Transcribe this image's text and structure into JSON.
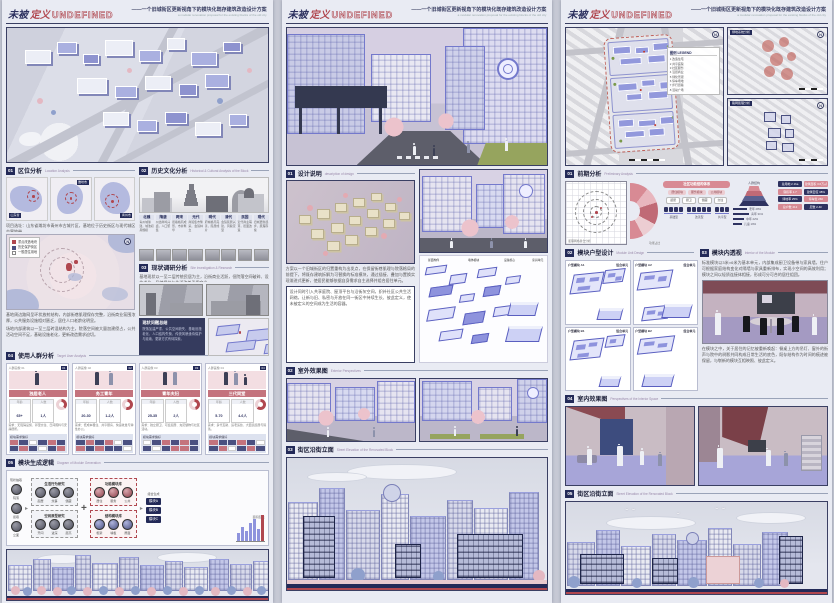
{
  "header": {
    "title_dark": "未被",
    "title_red": "定义",
    "title_en": "UNDEFINED",
    "subtitle": "——一个旧城街区更新视角下的模块化既存建筑改造设计方案",
    "subtitle_en": "a modular renovation proposal for the existing blocks of the old city"
  },
  "panel1": {
    "s1": {
      "num": "01",
      "title": "区位分析",
      "en": "Location Analysis"
    },
    "maps": {
      "tag1": "山东省",
      "tag2": "潍坊市",
      "tag3": "青州市",
      "caption": "项目选址：山东省潍坊市青州市古城片区，基地位于历史街区与现代城区交界地带。"
    },
    "legend": {
      "title": "图例",
      "items": [
        "重点改造地块",
        "历史保护街区",
        "一般居住用地"
      ]
    },
    "map_note1": "基地周边路网呈环状放射结构，内部街巷肌理保存完整，沿街商业氛围浓厚，公共服务设施相对匮乏，居住人口老龄化明显。",
    "map_note2": "场地内部建筑以一至三层砖混结构为主，院落空间被大量加建侵占，公共活动空间不足，基础设施老化，更新改造需求迫切。",
    "s1b": {
      "num": "02",
      "title": "历史文化分析",
      "en": "Historical & Cultural Analysis of the Block"
    },
    "timeline": [
      {
        "era": "北魏",
        "txt": "青州城肇建，城池初具规模"
      },
      {
        "era": "隋唐",
        "txt": "州治商埠兴盛，人口聚集"
      },
      {
        "era": "两宋",
        "txt": "街巷格局成形，市井繁华"
      },
      {
        "era": "元代",
        "txt": "商贸集市繁荣，会馆林立"
      },
      {
        "era": "明代",
        "txt": "府城格局完善，民居成片"
      },
      {
        "era": "清代",
        "txt": "会馆民居兴建，风貌定型"
      },
      {
        "era": "民国",
        "txt": "近代商业萌芽，街面改造"
      },
      {
        "era": "现代",
        "txt": "旧城更新起步，肌理存续"
      }
    ],
    "s1c": {
      "num": "03",
      "title": "现状调研分析",
      "en": "Site Investigation & Research"
    },
    "s1c_note": "基地现状以一至二层传统民居为主，沿街商业活跃，但院落空间破碎、设施老化，风貌保护与生活改善矛盾突出。",
    "dark_title": "现状问题总结",
    "dark_txt": "院落加建严重、公共空间缺失、基础设施老化、人口结构失衡，传统风貌亟待保护与延续，更新方式有待探索。",
    "s2": {
      "num": "04",
      "title": "使用人群分析",
      "en": "Target User Analysis"
    },
    "users": [
      {
        "tag": "人群画像 01",
        "no": "01",
        "name": "独居老人",
        "f1k": "年龄",
        "f1v": "65+",
        "f2k": "人数",
        "f2v": "1人",
        "circle": "占比",
        "grid": "模块需求偏好",
        "note": "需求：无障碍设施、邻里交往、日间照料与安静居所。"
      },
      {
        "tag": "人群画像 02",
        "no": "02",
        "name": "务工青年",
        "f1k": "年龄",
        "f1v": "20-30",
        "f2k": "人数",
        "f2v": "1-2人",
        "circle": "占比",
        "grid": "模块需求偏好",
        "note": "需求：低成本租住、共享厨房、快递收发与弹性办公。"
      },
      {
        "tag": "人群画像 03",
        "no": "03",
        "name": "青年夫妇",
        "f1k": "年龄",
        "f1v": "25-35",
        "f2k": "人数",
        "f2v": "2人",
        "circle": "占比",
        "grid": "模块需求偏好",
        "note": "需求：独立厨卫、可变起居、充足储物与社区活动。"
      },
      {
        "tag": "人群画像 04",
        "no": "04",
        "name": "三代同堂",
        "f1k": "年龄",
        "f1v": "5-70",
        "f2k": "人数",
        "f2v": "4-6人",
        "circle": "占比",
        "grid": "模块需求偏好",
        "note": "需求：多代互助、适老适幼、大面宽起居与院落。"
      }
    ],
    "s3": {
      "num": "05",
      "title": "模块生成逻辑",
      "en": "Diagram of Module Generation"
    },
    "flow": {
      "src": "现状抽取",
      "src_items": [
        "院落",
        "街巷",
        "立面"
      ],
      "g1": "生活行为研究",
      "g1_items": [
        "起居",
        "炊事",
        "储藏"
      ],
      "g2": "空间原型研究",
      "g2_items": [
        "开间",
        "进深",
        "层高"
      ],
      "m1": "功能模块库",
      "m1_items": [
        "居住",
        "服务",
        "公共"
      ],
      "m2": "结构模块库",
      "m2_items": [
        "框架",
        "墙板",
        "屋面"
      ],
      "out": "组合生成",
      "outs": [
        "模块A",
        "模块B",
        "模块C"
      ],
      "chart_cap": "面积配比"
    },
    "chart_data": {
      "type": "bar",
      "categories": [
        "A",
        "B",
        "C",
        "D",
        "E",
        "F",
        "G"
      ],
      "values": [
        8,
        14,
        10,
        18,
        22,
        12,
        26
      ],
      "title": "面积配比",
      "xlabel": "",
      "ylabel": "",
      "ylim": [
        0,
        30
      ]
    }
  },
  "panel2": {
    "s1": {
      "num": "01",
      "title": "设计说明",
      "en": "description of design"
    },
    "p1": "方案以一个旧城街区的归置重构为出发点，在保留街巷肌理与院落格局的前提下，将既存建筑拆解为可替换的标准模块，通过插接、叠加与置换实现渐进式更新，使居民能够依据自身需求自主选择并组合居住单元。",
    "p2": "设计同时引入共享庭院、屋顶平台与沿街灰空间，织补社区公共生活网络，让新与旧、私密与开放在同一街区中持续生长、彼此定义，使未被定义的空间成为生活的容器。",
    "axon_cap": "模块拆解轴测",
    "axon_labels": [
      "屋面构件",
      "墙体模块",
      "设备核心",
      "家具单元"
    ],
    "s2": {
      "num": "02",
      "title": "室外效果图",
      "en": "Exterior Perspectives"
    },
    "s3": {
      "num": "03",
      "title": "街区沿街立面",
      "en": "Street Elevation of the Renovated Block"
    }
  },
  "panel3": {
    "plan": {
      "legend_title": "图例 LEGEND",
      "legend_items": [
        "1 改造住宅",
        "2 共享庭院",
        "3 社区服务",
        "4 沿街商业",
        "5 绿化景观",
        "6 停车场地",
        "7 步行街巷",
        "8 活动广场"
      ],
      "small1": "绿地系统分析",
      "small2": "路网肌理分析"
    },
    "s1": {
      "num": "01",
      "title": "前期分析",
      "en": "Preliminary Analysis"
    },
    "ana": {
      "grid_cap": "肌理网格叠合分析",
      "fan_cap": "功能占比",
      "org_title": "社区功能结构体系",
      "org_row1": [
        "居住模块",
        "服务模块",
        "公共模块"
      ],
      "org_row2": [
        "起居",
        "厨卫",
        "储藏",
        "交往"
      ],
      "dot_labels": [
        "基础型",
        "改善型",
        "共享型"
      ],
      "pyr_cap": "人群结构",
      "pyr_items": [
        "老年 28%",
        "青年 31%",
        "中年 22%",
        "儿童 19%"
      ],
      "table": [
        "总用地 2.1ha",
        "建筑面积 3.6万㎡",
        "容积率 1.7",
        "建筑密度 38%",
        "绿地率 25%",
        "停车位 260",
        "总户数 412",
        "层数 2-4F"
      ]
    },
    "s2": {
      "num": "02",
      "title": "模块户型设计",
      "en": "Module Unit Design"
    },
    "mods": [
      {
        "l": "户型模块 A1",
        "r": "组合单元"
      },
      {
        "l": "户型模块 A2",
        "r": "组合单元"
      },
      {
        "l": "户型模块 B1",
        "r": "组合单元"
      },
      {
        "l": "户型模块 B2",
        "r": "组合单元"
      }
    ],
    "s3": {
      "num": "03",
      "title": "模块内透视",
      "en": "Interior of the Module"
    },
    "p1": "标准模块以3米×6米为基本单元，内部集成厨卫设备带与家具墙，住户可根据家庭结构变化对隔墙与家具重新排布，实现小空间的高效利用；模块之间以轻质连接体相接，形成可分可合的居住组团。",
    "p2": "在模块之中，关于居住的记忆被重新唤起：餐桌上方的吊灯、窗外的街声与院中的树影共同构成日常生活的底色，既存结构作为时间的痕迹被保留，与崭新的模块互相映照、彼此定义。",
    "s4": {
      "num": "04",
      "title": "室内效果图",
      "en": "Perspectives of the Interior Space"
    },
    "s5": {
      "num": "05",
      "title": "街区沿街立面",
      "en": "Street Elevation of the Renovated Block"
    }
  }
}
